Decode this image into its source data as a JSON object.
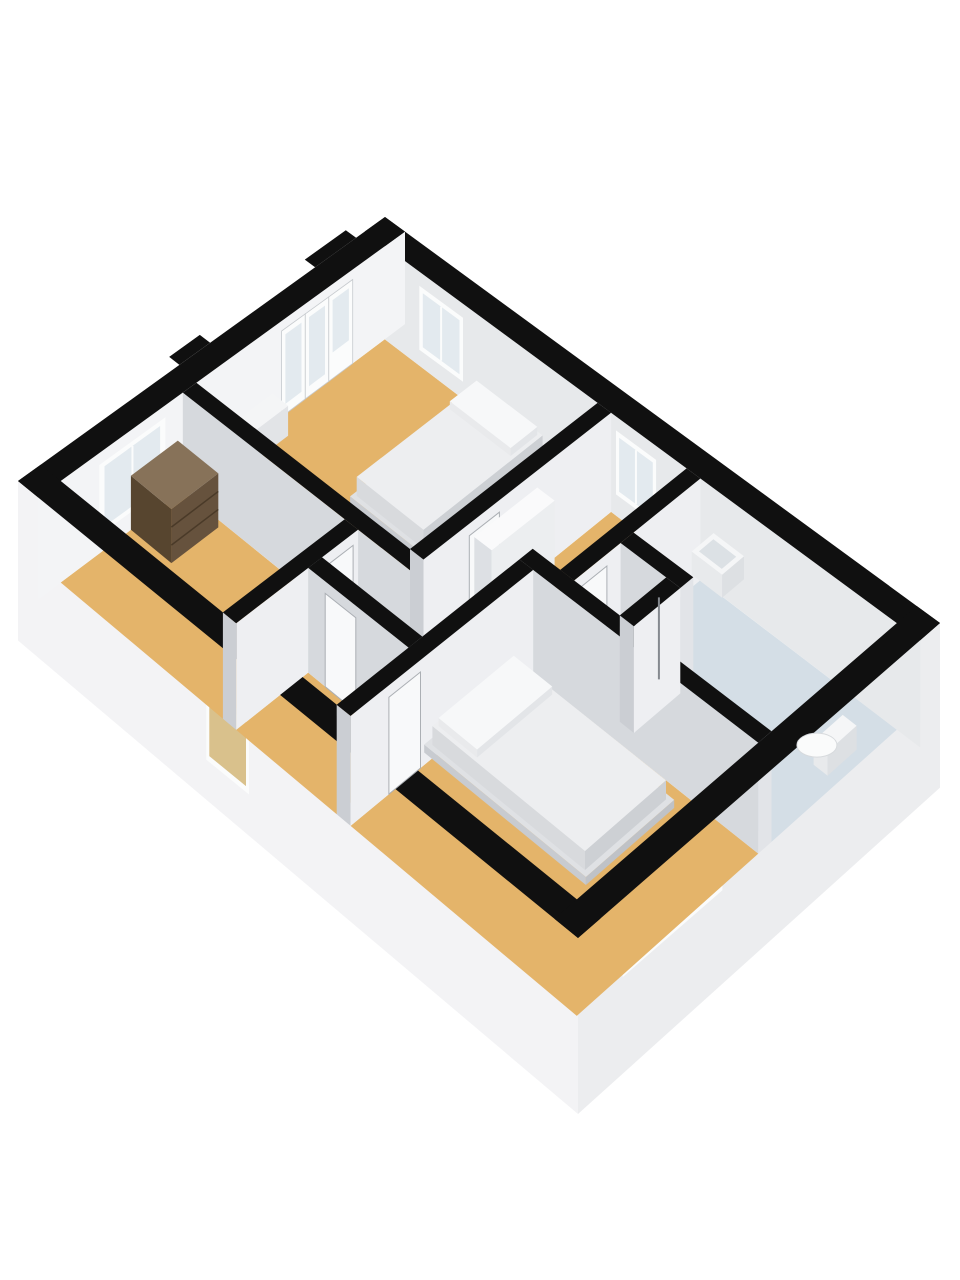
{
  "meta": {
    "title": "3d-floorplan-rendering",
    "view": "axonometric-top",
    "canvas": {
      "width": 960,
      "height": 1280,
      "background": "#ffffff"
    }
  },
  "palette": {
    "wall_top_black": "#101010",
    "floor_wood_tan": "#E4B46A",
    "floor_bathroom_blue": "#D4DEE6",
    "floor_shower_gray": "#E9EBED",
    "wall_face_bright": "#F3F4F6",
    "wall_face_light": "#EEEFF2",
    "wall_face_medium": "#D6D9DD",
    "wall_face_cap": "#CBCED3",
    "wall_face_ne_interior": "#E7E9EB",
    "fascia_sw": "#F3F3F5",
    "fascia_se": "#ECEDEF",
    "glass_pale": "#E3EAEF",
    "glass_tan_reflection": "#D9C18C",
    "frame_white": "#FBFCFC",
    "door_leaf": "#F8F9FA",
    "furniture_white": "#F5F6F7",
    "dresser_brown_top": "#877259",
    "dresser_brown_front": "#66523D",
    "dresser_brown_side": "#57452F"
  },
  "projection": {
    "plan_size": [
      9,
      6
    ],
    "screen_corners": {
      "N": [
        385,
        217
      ],
      "E": [
        940,
        623
      ],
      "S": [
        578,
        938
      ],
      "W": [
        18,
        481
      ]
    },
    "wall_height_px": {
      "north": 92,
      "south": 118
    },
    "slab_depth_px": 58
  },
  "fascia": [
    {
      "name": "fascia-sw",
      "edge": "sw",
      "color": "#F3F3F5"
    },
    {
      "name": "fascia-se",
      "edge": "se",
      "color": "#ECEDEF"
    }
  ],
  "fascia_windows": [
    {
      "name": "window-left-room-sw",
      "face": "sw",
      "a": 3.2,
      "b": 3.9,
      "o1": 30,
      "o2": 125,
      "glass": "#D9C18C"
    },
    {
      "name": "window-bedroom2-se",
      "face": "se",
      "a": 3.7,
      "b": 5.3,
      "o1": 10,
      "o2": 78,
      "glass": "#D9C18C",
      "mullion": true
    },
    {
      "name": "window-bathroom-se",
      "face": "se",
      "a": 1.55,
      "b": 2.1,
      "o1": 8,
      "o2": 64,
      "glass": "#E3EAEF"
    }
  ],
  "bumpouts": [
    {
      "name": "wall-bumpout-north",
      "rect": [
        -0.18,
        0.5,
        0,
        1.2
      ]
    },
    {
      "name": "wall-bumpout-west",
      "rect": [
        -0.18,
        2.95,
        0,
        3.45
      ]
    }
  ],
  "floors": [
    {
      "name": "floor-bedroom-top",
      "rect": [
        0.35,
        0.35,
        3.95,
        3.5
      ],
      "color": "#E4B46A"
    },
    {
      "name": "floor-left-room",
      "rect": [
        0.35,
        3.72,
        3.1,
        5.65
      ],
      "color": "#E4B46A"
    },
    {
      "name": "floor-hall-north",
      "rect": [
        4.17,
        0.35,
        5.39,
        2.5
      ],
      "color": "#E4B46A"
    },
    {
      "name": "floor-hall-south",
      "rect": [
        4.17,
        2.5,
        4.95,
        4.3
      ],
      "color": "#E4B46A"
    },
    {
      "name": "floor-hall-spur",
      "rect": [
        3.32,
        3.72,
        4.17,
        4.3
      ],
      "color": "#E4B46A"
    },
    {
      "name": "floor-vestibule",
      "rect": [
        3.32,
        4.52,
        4.95,
        5.65
      ],
      "color": "#E4B46A"
    },
    {
      "name": "floor-bedroom-btm",
      "rect": [
        5.17,
        2.72,
        8.65,
        5.65
      ],
      "color": "#E4B46A"
    },
    {
      "name": "floor-bathroom",
      "rect": [
        5.61,
        0.35,
        8.65,
        2.5
      ],
      "color": "#D4DEE6"
    },
    {
      "name": "floor-shower",
      "rect": [
        5.61,
        1.72,
        6.33,
        2.5
      ],
      "color": "#E9EBED"
    }
  ],
  "walls": [
    {
      "name": "wall-ext-ne",
      "rect": [
        0,
        0,
        9,
        0.35
      ],
      "top": "#101010",
      "ymax": "#E7E9EB",
      "openings": [
        {
          "kind": "window",
          "side": "ymax",
          "a": 0.95,
          "b": 1.7,
          "o1": 14,
          "o2": 78
        },
        {
          "kind": "window",
          "side": "ymax",
          "a": 4.25,
          "b": 4.9,
          "o1": 14,
          "o2": 78
        }
      ]
    },
    {
      "name": "wall-ext-nw",
      "rect": [
        0,
        0,
        0.35,
        6
      ],
      "top": "#101010",
      "xmax": "#F3F4F6",
      "openings": [
        {
          "kind": "glassdoor",
          "side": "xmax",
          "a": 0.9,
          "b": 2.1,
          "o1": 10
        },
        {
          "kind": "window",
          "side": "xmax",
          "a": 4.0,
          "b": 5.05,
          "o1": 12,
          "o2": 82
        }
      ]
    },
    {
      "name": "wall-ext-se",
      "rect": [
        8.65,
        0,
        9,
        6
      ],
      "top": "#101010"
    },
    {
      "name": "wall-ext-sw",
      "rect": [
        0,
        5.65,
        9,
        6
      ],
      "top": "#101010"
    },
    {
      "name": "wall-bedroom-top-se",
      "rect": [
        3.95,
        0.35,
        4.17,
        3.5
      ],
      "top": "#101010",
      "xmax": "#EEEFF2",
      "ymax": "#CBCED3",
      "openings": [
        {
          "kind": "door",
          "side": "xmax",
          "a": 2.25,
          "b": 2.75
        }
      ]
    },
    {
      "name": "wall-bedroom-top-sw",
      "rect": [
        0.35,
        3.5,
        4.17,
        3.72
      ],
      "top": "#101010",
      "ymax": "#D6D9DD",
      "xmax": "#E2E4E8"
    },
    {
      "name": "wall-bathroom-sw",
      "rect": [
        4.95,
        2.5,
        8.65,
        2.72
      ],
      "top": "#101010",
      "ymax": "#D6D9DD",
      "xmax": "#E2E4E8"
    },
    {
      "name": "wall-bedroom-btm-nw",
      "rect": [
        4.95,
        2.72,
        5.17,
        5.65
      ],
      "top": "#101010",
      "xmax": "#EEEFF2",
      "ymax": "#CBCED3",
      "openings": [
        {
          "kind": "door",
          "side": "xmax",
          "a": 4.55,
          "b": 5.05
        }
      ]
    },
    {
      "name": "wall-left-room-se",
      "rect": [
        3.1,
        3.72,
        3.32,
        5.65
      ],
      "top": "#101010",
      "xmax": "#EEEFF2",
      "ymax": "#CBCED3",
      "openings": [
        {
          "kind": "door",
          "side": "xmax",
          "a": 3.8,
          "b": 4.3
        }
      ]
    },
    {
      "name": "wall-vestibule-ne",
      "rect": [
        3.32,
        4.3,
        4.95,
        4.52
      ],
      "top": "#101010",
      "ymax": "#D6D9DD",
      "xmax": "#E2E4E8",
      "openings": [
        {
          "kind": "door",
          "side": "ymax",
          "a": 3.6,
          "b": 4.1
        }
      ]
    },
    {
      "name": "wall-bathroom-nw",
      "rect": [
        5.39,
        0.35,
        5.61,
        2.5
      ],
      "top": "#101010",
      "xmax": "#EEEFF2",
      "ymax": "#CBCED3",
      "openings": [
        {
          "kind": "door",
          "side": "xmax",
          "a": 1.95,
          "b": 2.4
        }
      ]
    },
    {
      "name": "wall-shower-ne",
      "rect": [
        5.61,
        1.5,
        6.55,
        1.72
      ],
      "top": "#101010",
      "ymax": "#D6D9DD",
      "xmax": "#E2E4E8"
    },
    {
      "name": "wall-shower-se",
      "rect": [
        6.33,
        1.72,
        6.55,
        2.5
      ],
      "top": "#101010",
      "xmax": "#EEEFF2",
      "ymax": "#CBCED3"
    },
    {
      "name": "stair-partition",
      "rect": [
        4.35,
        1.8,
        4.63,
        2.85
      ],
      "top": "#FAFAFB",
      "xmax": "#ECEEF0",
      "ymax": "#DDE0E4",
      "hf": 0.95
    }
  ],
  "furniture": [
    {
      "name": "bed1-base",
      "rect": [
        1.9,
        0.33,
        3.12,
        2.46
      ],
      "z0": 0,
      "z1": 8,
      "top": "#DFE1E4",
      "xmax": "#BFC2C7",
      "ymax": "#C8CBD0"
    },
    {
      "name": "bed1-mattress",
      "rect": [
        1.95,
        0.38,
        3.07,
        2.4
      ],
      "z0": 8,
      "z1": 27,
      "top": "#EDEEF0",
      "xmax": "#CDD0D4",
      "ymax": "#D8DADD"
    },
    {
      "name": "bed1-pillow",
      "rect": [
        2.0,
        0.42,
        3.02,
        0.88
      ],
      "z0": 27,
      "z1": 35,
      "top": "#F7F8F9",
      "xmax": "#E3E5E8",
      "ymax": "#E9EAEC"
    },
    {
      "name": "bed2-base",
      "rect": [
        5.05,
        2.93,
        7.57,
        4.37
      ],
      "z0": 0,
      "z1": 8,
      "top": "#DFE1E4",
      "xmax": "#BFC2C7",
      "ymax": "#C8CBD0"
    },
    {
      "name": "bed2-mattress",
      "rect": [
        5.12,
        2.99,
        7.5,
        4.31
      ],
      "z0": 8,
      "z1": 27,
      "top": "#EDEEF0",
      "xmax": "#CDD0D4",
      "ymax": "#D8DADD"
    },
    {
      "name": "bed2-pillow",
      "rect": [
        5.17,
        3.04,
        5.78,
        4.26
      ],
      "z0": 27,
      "z1": 35,
      "top": "#F7F8F9",
      "xmax": "#E3E5E8",
      "ymax": "#E9EAEC"
    },
    {
      "name": "dresser",
      "rect": [
        0.35,
        3.8,
        1.05,
        4.55
      ],
      "z0": 0,
      "z1": 54,
      "top": "#877259",
      "xmax": "#66523D",
      "ymax": "#57452F",
      "drawer_lines": [
        18,
        36
      ],
      "drawer_color": "#4A3A28"
    },
    {
      "name": "cabinet-nw",
      "rect": [
        0.35,
        2.25,
        0.62,
        2.85
      ],
      "z0": 0,
      "z1": 30,
      "top": "#F4F5F6",
      "xmax": "#E2E4E7",
      "ymax": "#EAECEE"
    },
    {
      "name": "bathroom-sink",
      "rect": [
        5.82,
        0.35,
        6.3,
        0.73
      ],
      "z0": 34,
      "z1": 57,
      "top": "#F5F6F7",
      "xmax": "#DDE0E3",
      "ymax": "#E8EAEC",
      "basin": [
        5.88,
        0.42,
        6.24,
        0.67
      ],
      "basin_color": "#DCE1E5"
    },
    {
      "name": "toilet-tank",
      "rect": [
        8.44,
        1.05,
        8.65,
        1.55
      ],
      "z0": 16,
      "z1": 40,
      "top": "#F5F6F7",
      "xmax": "#DDE0E3",
      "ymax": "#E8EAEC"
    }
  ],
  "extras": [
    {
      "name": "toilet-bowl",
      "type": "ellipse",
      "at": [
        8.27,
        1.3
      ],
      "z": 14,
      "rx": 20,
      "ry": 12,
      "fill": "#FAFBFB",
      "stroke": "#D7DADD"
    },
    {
      "name": "shower-column",
      "type": "line",
      "at": [
        6.28,
        1.79
      ],
      "z0": 4,
      "z1": 86,
      "stroke": "#85898F",
      "w": 2
    }
  ]
}
